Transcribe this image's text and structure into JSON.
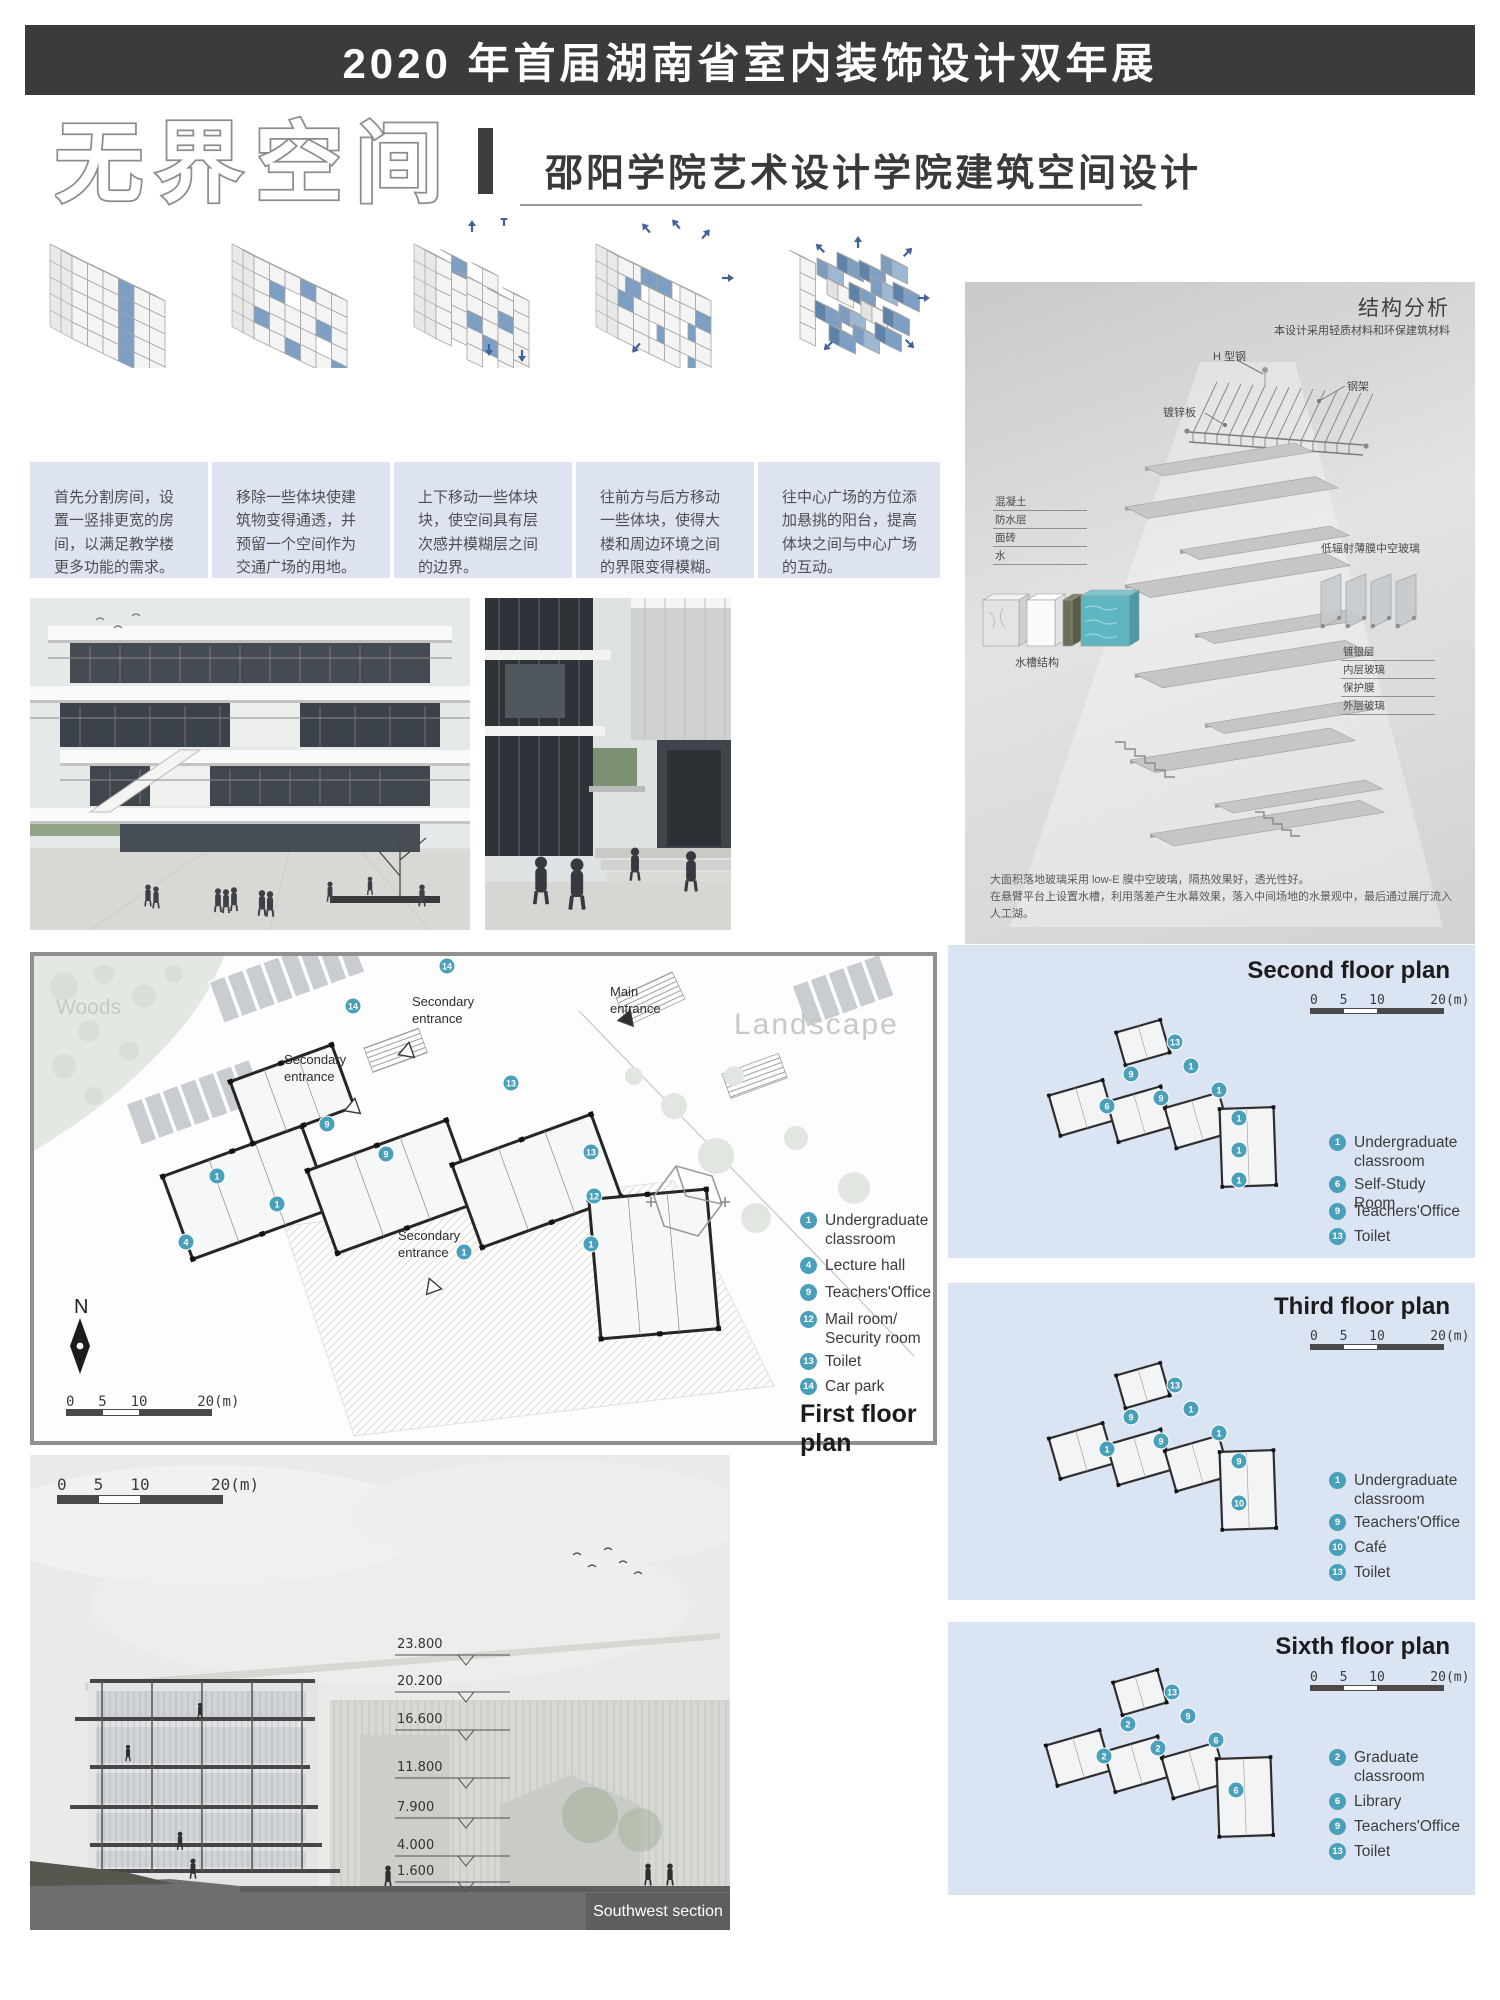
{
  "colors": {
    "header_bg": "#3b3b3b",
    "accent_teal": "#4aa0ba",
    "panel_blue": "#dbe4f2",
    "caption_bg": "#dee3f1",
    "massing_blue": "#7d9fc4"
  },
  "header": {
    "title": "2020 年首届湖南省室内装饰设计双年展"
  },
  "title_block": {
    "main_title": "无界空间",
    "divider": "|",
    "subtitle": "邵阳学院艺术设计学院建筑空间设计"
  },
  "massing_captions": [
    "首先分割房间，设置一竖排更宽的房间，以满足教学楼更多功能的需求。",
    "移除一些体块使建筑物变得通透，并预留一个空间作为交通广场的用地。",
    "上下移动一些体块块，使空间具有层次感并模糊层之间的边界。",
    "往前方与后方移动一些体块，使得大楼和周边环境之间的界限变得模糊。",
    "往中心广场的方位添加悬挑的阳台，提高体块之间与中心广场的互动。"
  ],
  "structure": {
    "title": "结构分析",
    "subtitle": "本设计采用轻质材料和环保建筑材料",
    "label_h_steel": "H 型钢",
    "label_steel_frame": "钢架",
    "label_galvanized": "镀锌板",
    "roof_layers": [
      "混凝土",
      "防水层",
      "面砖",
      "水"
    ],
    "label_water_tank": "水槽结构",
    "label_low_e": "低辐射薄膜中空玻璃",
    "glass_layers": [
      "镀银层",
      "内层玻璃",
      "保护膜",
      "外层玻璃"
    ],
    "desc1": "大面积落地玻璃采用 low-E 膜中空玻璃，隔热效果好，透光性好。",
    "desc2": "在悬臂平台上设置水槽，利用落差产生水幕效果，落入中间场地的水景观中，最后通过展厅流入人工湖。"
  },
  "first_floor_plan": {
    "title": "First floor plan",
    "labels": {
      "woods": "Woods",
      "landscape": "Landscape",
      "main_entrance": "Main entrance",
      "secondary_entrance": "Secondary entrance",
      "north": "N"
    },
    "scale_ticks": [
      "0",
      "5",
      "10",
      "20(m)"
    ],
    "legend": [
      {
        "num": "1",
        "label": "Undergraduate classroom"
      },
      {
        "num": "4",
        "label": "Lecture hall"
      },
      {
        "num": "9",
        "label": "Teachers'Office"
      },
      {
        "num": "12",
        "label": "Mail room/ Security room"
      },
      {
        "num": "13",
        "label": "Toilet"
      },
      {
        "num": "14",
        "label": "Car park"
      }
    ],
    "markers": [
      {
        "n": "14",
        "x": 413,
        "y": 10
      },
      {
        "n": "14",
        "x": 319,
        "y": 50
      },
      {
        "n": "13",
        "x": 477,
        "y": 127
      },
      {
        "n": "13",
        "x": 557,
        "y": 196
      },
      {
        "n": "12",
        "x": 560,
        "y": 240
      },
      {
        "n": "9",
        "x": 293,
        "y": 168
      },
      {
        "n": "9",
        "x": 352,
        "y": 198
      },
      {
        "n": "1",
        "x": 183,
        "y": 220
      },
      {
        "n": "1",
        "x": 243,
        "y": 248
      },
      {
        "n": "1",
        "x": 557,
        "y": 288
      },
      {
        "n": "4",
        "x": 152,
        "y": 286
      },
      {
        "n": "1",
        "x": 430,
        "y": 296
      }
    ]
  },
  "floor_plans": [
    {
      "title": "Second floor plan",
      "scale_ticks": [
        "0",
        "5",
        "10",
        "20(m)"
      ],
      "legend": [
        {
          "num": "1",
          "label": "Undergraduate classroom"
        },
        {
          "num": "6",
          "label": "Self-Study Room"
        },
        {
          "num": "9",
          "label": "Teachers'Office"
        },
        {
          "num": "13",
          "label": "Toilet"
        }
      ],
      "markers": [
        {
          "n": "13",
          "x": 152,
          "y": 52
        },
        {
          "n": "9",
          "x": 108,
          "y": 84
        },
        {
          "n": "1",
          "x": 168,
          "y": 76
        },
        {
          "n": "6",
          "x": 84,
          "y": 116
        },
        {
          "n": "9",
          "x": 138,
          "y": 108
        },
        {
          "n": "1",
          "x": 196,
          "y": 100
        },
        {
          "n": "1",
          "x": 216,
          "y": 128
        },
        {
          "n": "1",
          "x": 216,
          "y": 160
        },
        {
          "n": "1",
          "x": 216,
          "y": 190
        }
      ]
    },
    {
      "title": "Third floor plan",
      "scale_ticks": [
        "0",
        "5",
        "10",
        "20(m)"
      ],
      "legend": [
        {
          "num": "1",
          "label": "Undergraduate classroom"
        },
        {
          "num": "9",
          "label": "Teachers'Office"
        },
        {
          "num": "10",
          "label": "Café"
        },
        {
          "num": "13",
          "label": "Toilet"
        }
      ],
      "markers": [
        {
          "n": "13",
          "x": 152,
          "y": 52
        },
        {
          "n": "9",
          "x": 108,
          "y": 84
        },
        {
          "n": "1",
          "x": 168,
          "y": 76
        },
        {
          "n": "1",
          "x": 84,
          "y": 116
        },
        {
          "n": "9",
          "x": 138,
          "y": 108
        },
        {
          "n": "1",
          "x": 196,
          "y": 100
        },
        {
          "n": "9",
          "x": 216,
          "y": 128
        },
        {
          "n": "10",
          "x": 216,
          "y": 170
        }
      ]
    },
    {
      "title": "Sixth floor plan",
      "scale_ticks": [
        "0",
        "5",
        "10",
        "20(m)"
      ],
      "legend": [
        {
          "num": "2",
          "label": "Graduate classroom"
        },
        {
          "num": "6",
          "label": "Library"
        },
        {
          "num": "9",
          "label": "Teachers'Office"
        },
        {
          "num": "13",
          "label": "Toilet"
        }
      ],
      "markers": [
        {
          "n": "13",
          "x": 152,
          "y": 52
        },
        {
          "n": "9",
          "x": 168,
          "y": 76
        },
        {
          "n": "2",
          "x": 108,
          "y": 84
        },
        {
          "n": "2",
          "x": 84,
          "y": 116
        },
        {
          "n": "2",
          "x": 138,
          "y": 108
        },
        {
          "n": "6",
          "x": 196,
          "y": 100
        },
        {
          "n": "6",
          "x": 216,
          "y": 150
        }
      ]
    }
  ],
  "section": {
    "title": "Southwest section",
    "scale_ticks": [
      "0",
      "5",
      "10",
      "20(m)"
    ],
    "levels": [
      "23.800",
      "20.200",
      "16.600",
      "11.800",
      "7.900",
      "4.000",
      "1.600"
    ]
  }
}
